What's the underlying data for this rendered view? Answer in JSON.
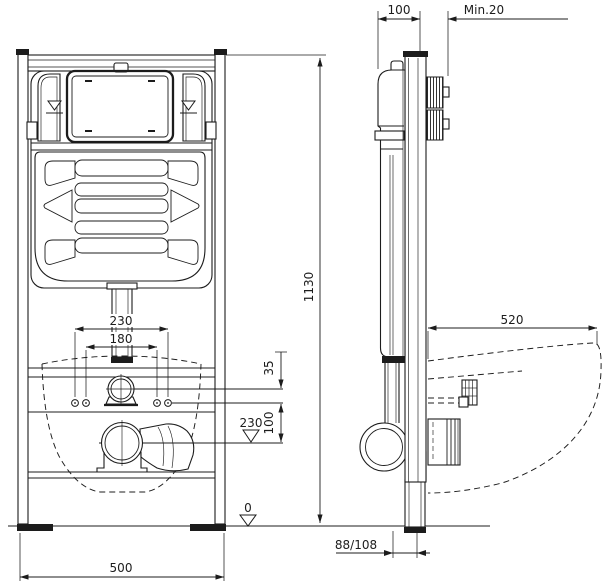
{
  "drawing": {
    "front_view": {
      "height": "1130",
      "width": "500",
      "holes_outer": "230",
      "holes_inner": "180",
      "supply_offset": "35",
      "drain_offset": "100",
      "drain_level": "230",
      "floor_level": "0"
    },
    "side_view": {
      "frame_depth": "100",
      "wall_clearance_min": "Min.20",
      "bowl_depth": "520",
      "drain_wall_offset": "88/108"
    }
  }
}
